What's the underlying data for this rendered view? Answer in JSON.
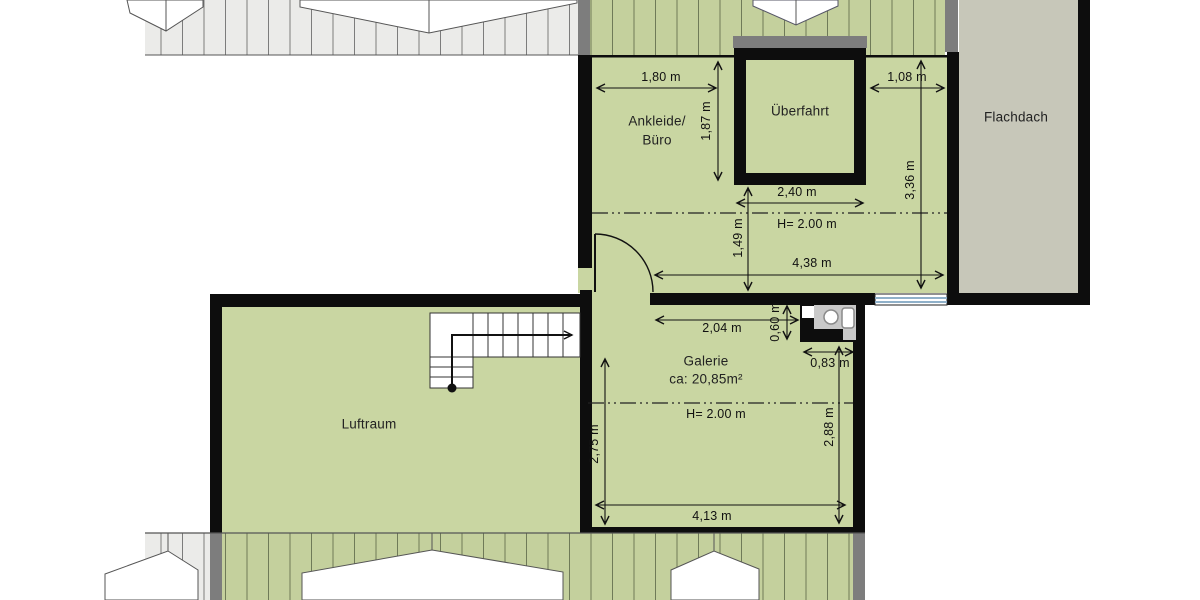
{
  "rooms": {
    "ankleide_line1": "Ankleide/",
    "ankleide_line2": "Büro",
    "ueberfahrt": "Überfahrt",
    "flachdach": "Flachdach",
    "galerie": "Galerie",
    "galerie_area": "ca: 20,85m²",
    "luftraum": "Luftraum"
  },
  "dimensions": {
    "ankleide_width": "1,80 m",
    "ankleide_height": "1,87 m",
    "right_strip_width": "1,08 m",
    "ueberfahrt_width": "2,40 m",
    "right_strip_height": "3,36 m",
    "below_ueberfahrt_height": "1,49 m",
    "upper_room_width": "4,38 m",
    "upper_ceiling_height": "H= 2.00 m",
    "galerie_top_width": "2,04 m",
    "wc_depth": "0,60 m",
    "wc_width": "0,83 m",
    "galerie_right_height": "2,88 m",
    "galerie_left_height": "2,75 m",
    "galerie_ceiling_height": "H= 2.00 m",
    "galerie_width": "4,13 m"
  },
  "colors": {
    "room_fill": "#c9d6a2",
    "roof_hatch_green_fill": "#c4d09d",
    "roof_hatch_grey_fill": "#ebebe9",
    "flat_roof_fill": "#c7c7b9",
    "wall_black": "#0d0d0d",
    "wall_dark_grey": "#7d7d7d",
    "window_blue": "#8fb0c9"
  }
}
